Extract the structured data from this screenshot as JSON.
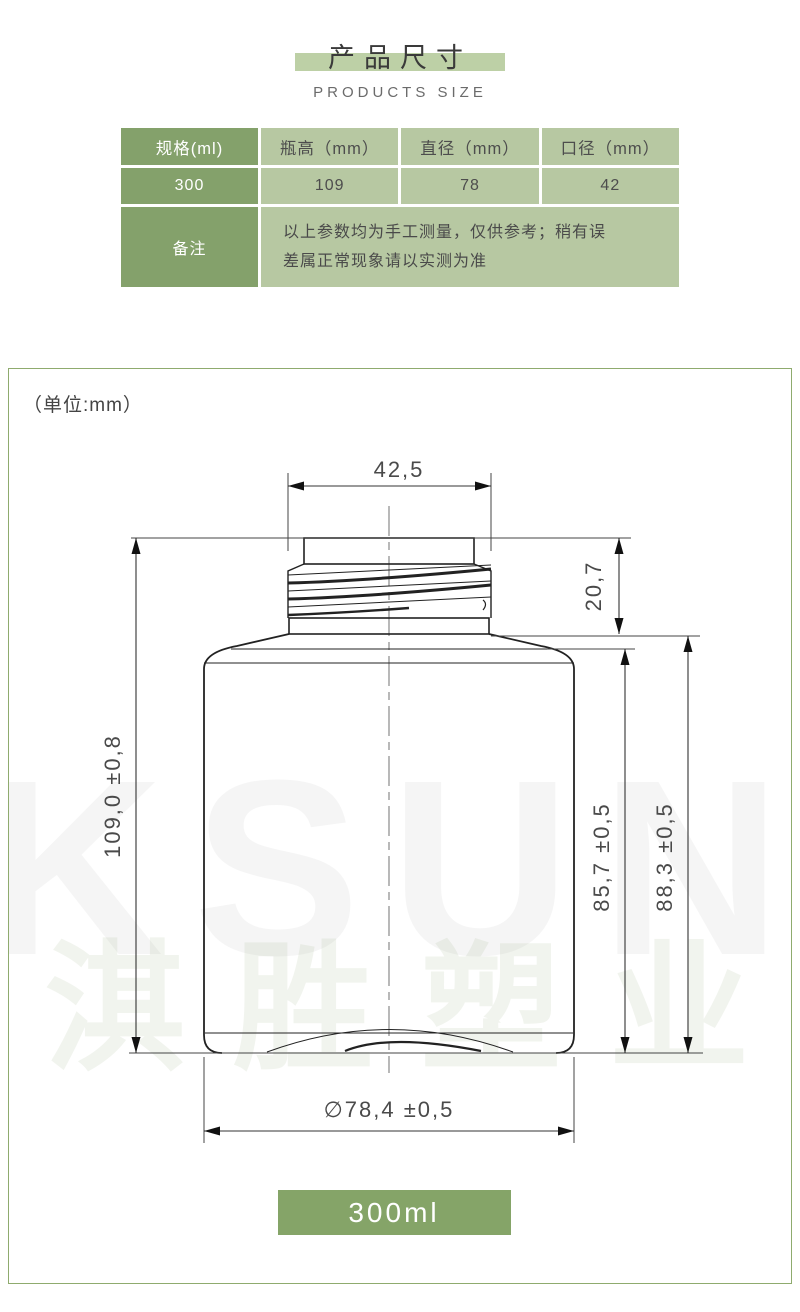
{
  "header": {
    "title": "产品尺寸",
    "subtitle": "PRODUCTS SIZE"
  },
  "spec_table": {
    "columns": [
      "规格(ml)",
      "瓶高（mm）",
      "直径（mm）",
      "口径（mm）"
    ],
    "row": [
      "300",
      "109",
      "78",
      "42"
    ],
    "note_label": "备注",
    "note_text": "以上参数均为手工测量，仅供参考；稍有误差属正常现象请以实测为准"
  },
  "drawing": {
    "unit_label": "（单位:mm）",
    "dims": {
      "neck_width": "42,5",
      "neck_height": "20,7",
      "total_height": "109,0  ±0,8",
      "body_height_inner": "85,7  ±0,5",
      "body_height_outer": "88,3  ±0,5",
      "diameter": "∅78,4  ±0,5"
    },
    "watermark_en": "KSUN",
    "watermark_cn": "淇胜塑业",
    "badge": "300ml"
  },
  "colors": {
    "accent_dark_green": "#84a16b",
    "accent_light_green": "#b7c8a2",
    "title_band_green": "#bdd0a6",
    "border_green": "#8fab6e",
    "badge_green": "#85a468"
  }
}
